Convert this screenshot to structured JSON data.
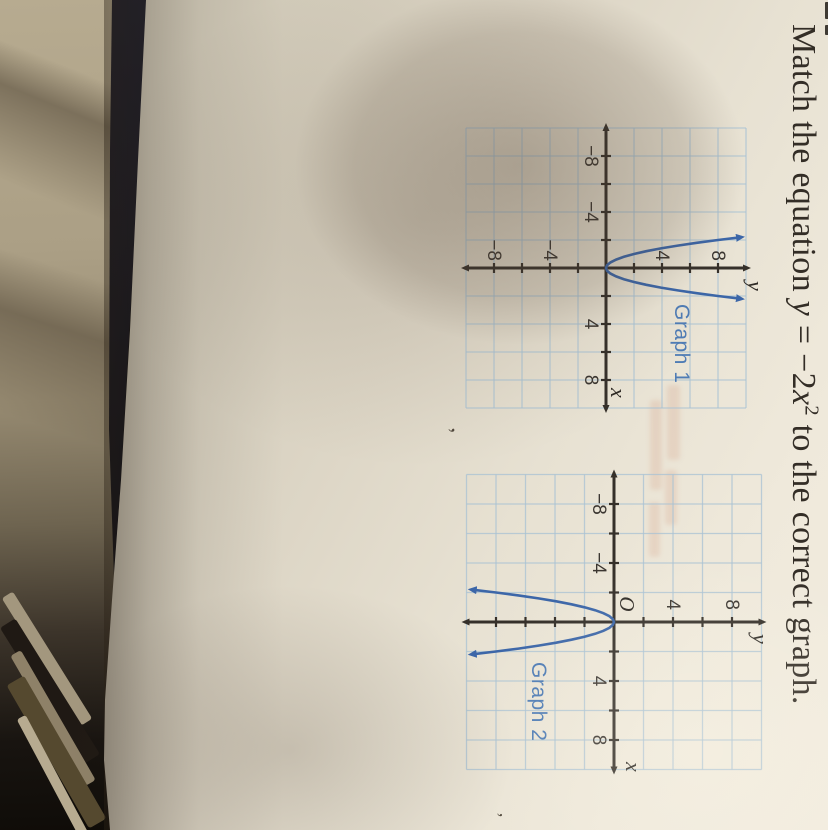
{
  "title": {
    "pre": "Match the equation ",
    "y_var": "y",
    "mid": " = −2",
    "x_var": "x",
    "exponent": "2",
    "post": " to the correct graph."
  },
  "graphs": [
    {
      "label": "Graph 1",
      "x_axis_label": "x",
      "y_axis_label": "y",
      "x_tick_labels": [
        "−8",
        "−4",
        "4",
        "8"
      ],
      "y_tick_labels": [
        "8",
        "4",
        "−4",
        "−8"
      ]
    },
    {
      "label": "Graph 2",
      "origin_label": "O",
      "x_axis_label": "x",
      "y_axis_label": "y",
      "x_tick_labels": [
        "−8",
        "−4",
        "4",
        "8"
      ],
      "y_tick_labels": [
        "8",
        "4"
      ]
    }
  ],
  "chart_data": [
    {
      "type": "line",
      "title": "Graph 1",
      "xlabel": "x",
      "ylabel": "y",
      "xlim": [
        -10,
        10
      ],
      "ylim": [
        -10,
        10
      ],
      "grid": true,
      "grid_step": 2,
      "tick_labels": {
        "x": [
          -8,
          -4,
          4,
          8
        ],
        "y": [
          8,
          4,
          -4,
          -8
        ]
      },
      "curve_equation": "y = 2x^2",
      "x": [
        -2.2,
        -2,
        -1.8,
        -1.6,
        -1.4,
        -1.2,
        -1,
        -0.8,
        -0.6,
        -0.4,
        -0.2,
        0,
        0.2,
        0.4,
        0.6,
        0.8,
        1,
        1.2,
        1.4,
        1.6,
        1.8,
        2,
        2.2
      ],
      "y": [
        9.68,
        8,
        6.48,
        5.12,
        3.92,
        2.88,
        2,
        1.28,
        0.72,
        0.32,
        0.08,
        0,
        0.08,
        0.32,
        0.72,
        1.28,
        2,
        2.88,
        3.92,
        5.12,
        6.48,
        8,
        9.68
      ]
    },
    {
      "type": "line",
      "title": "Graph 2",
      "xlabel": "x",
      "ylabel": "y",
      "origin_label": "O",
      "xlim": [
        -10,
        10
      ],
      "ylim": [
        -10,
        10
      ],
      "grid": true,
      "grid_step": 2,
      "tick_labels": {
        "x": [
          -8,
          -4,
          4,
          8
        ],
        "y": [
          8,
          4
        ]
      },
      "curve_equation": "y = -2x^2",
      "x": [
        -2.2,
        -2,
        -1.8,
        -1.6,
        -1.4,
        -1.2,
        -1,
        -0.8,
        -0.6,
        -0.4,
        -0.2,
        0,
        0.2,
        0.4,
        0.6,
        0.8,
        1,
        1.2,
        1.4,
        1.6,
        1.8,
        2,
        2.2
      ],
      "y": [
        -9.68,
        -8,
        -6.48,
        -5.12,
        -3.92,
        -2.88,
        -2,
        -1.28,
        -0.72,
        -0.32,
        -0.08,
        0,
        -0.08,
        -0.32,
        -0.72,
        -1.28,
        -2,
        -2.88,
        -3.92,
        -5.12,
        -6.48,
        -8,
        -9.68
      ]
    }
  ]
}
